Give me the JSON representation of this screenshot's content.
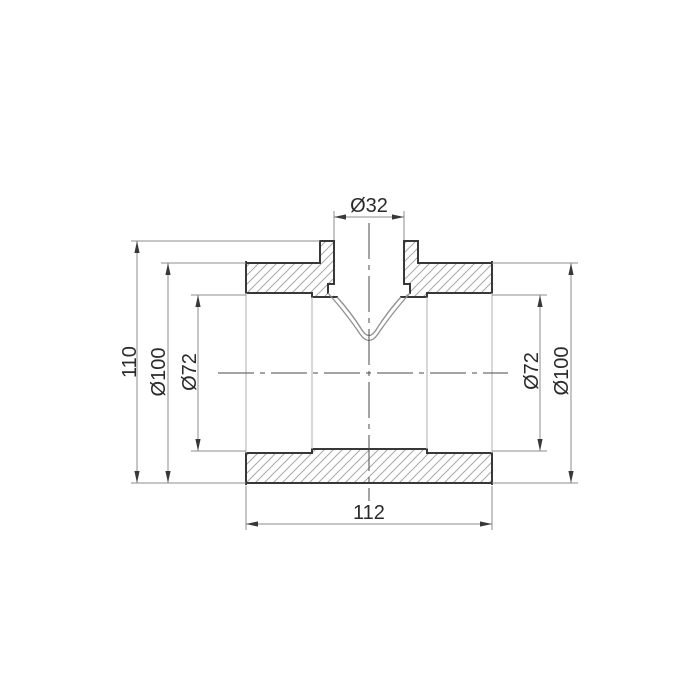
{
  "page": {
    "background": "#ffffff"
  },
  "drawing": {
    "title": "Pipe tee fitting cross-section technical drawing",
    "labels": {
      "total_height": "110",
      "outer_diameter_left": "Ø100",
      "bore_diameter_left": "Ø72",
      "branch_bore_diameter": "Ø32",
      "bore_diameter_right": "Ø72",
      "outer_diameter_right": "Ø100",
      "overall_length": "112"
    },
    "colors": {
      "background": "#ffffff",
      "outline_thick": "#383838",
      "projection_light": "#bdbdbd",
      "funnel_line": "#8f8f8f",
      "centerline": "#4a4a4a",
      "dimension_line": "#8e8e8e",
      "hatch": "#a8a8a8",
      "text": "#2b2b2b"
    }
  }
}
